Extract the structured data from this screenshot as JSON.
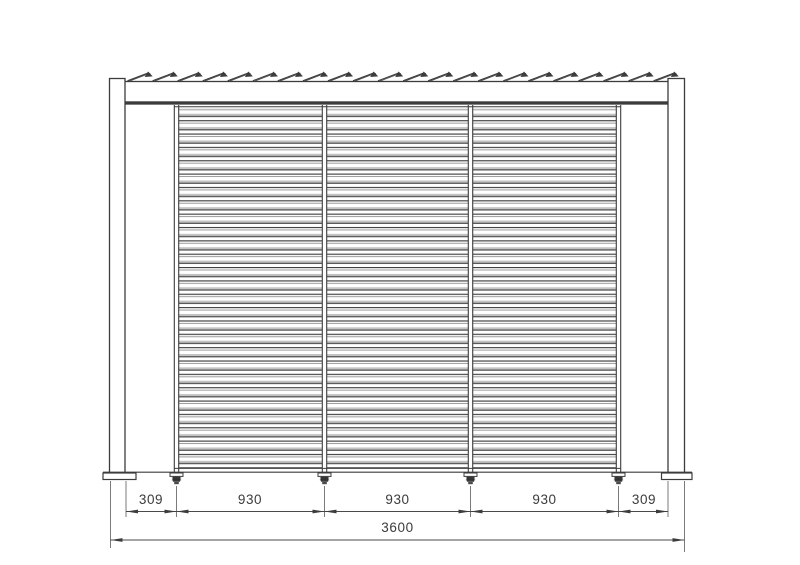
{
  "drawing": {
    "view": "front-elevation",
    "dimensions": {
      "row": [
        "309",
        "930",
        "930",
        "930",
        "309"
      ],
      "total": "3600"
    },
    "colors": {
      "line": "#3c3c3c",
      "background": "#ffffff"
    }
  }
}
